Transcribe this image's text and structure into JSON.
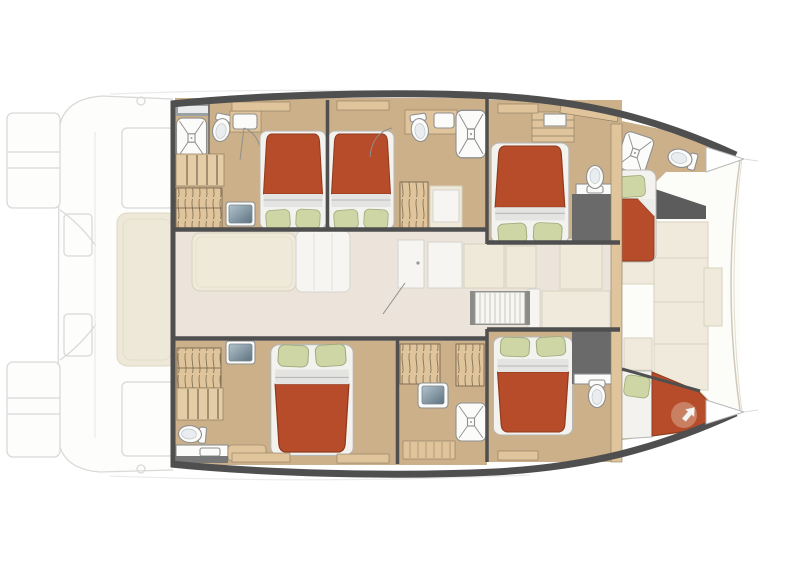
{
  "document": {
    "type": "floor-plan",
    "subject": "catamaran yacht interior deck plan, top view",
    "canvas": {
      "width": 800,
      "height": 572
    },
    "visible_text": "none"
  },
  "palette": {
    "bed": "#b64c2a",
    "bed_dark": "#8f3a1f",
    "pillow": "#cdd6a4",
    "pillow_edge": "#9dab7c",
    "sheet": "#e4e4e2",
    "sheet_line": "#b9b9b9",
    "cabin_floor": "#cbb08a",
    "wood": "#dfc49c",
    "wood_step": "#e4cda6",
    "hatch": "#85755a",
    "wall": "#4f4f4f",
    "wall_light": "#6a6a6a",
    "salon_floor": "#ece3da",
    "furniture_cream": "#efe9d9",
    "furniture_white": "#f6f5f1",
    "fixture": "#fbfbfa",
    "fixture_edge": "#8f8f8f",
    "glossy_hi": "#b3c3cc",
    "glossy_lo": "#5d7380",
    "panel": "#efeadb",
    "panel_edge": "#d7d1bf",
    "ghost": "#d9d9d9",
    "ghost_pad": "#ede8d8"
  },
  "fixture_counts": {
    "double_beds": 5,
    "single_bow_beds": 2,
    "showers": 5,
    "toilets": 6,
    "washbasins": 4,
    "hanging_wardrobes": 5,
    "staircases": 2
  },
  "rooms": [
    {
      "name": "aft-port-cabin",
      "fixtures": [
        "double-bed",
        "shower",
        "toilet",
        "washbasin",
        "stairs",
        "hanging-wardrobe",
        "vanity-table"
      ]
    },
    {
      "name": "mid-port-cabin",
      "fixtures": [
        "double-bed",
        "toilet",
        "washbasin",
        "shower",
        "hanging-wardrobe",
        "bench-seat"
      ]
    },
    {
      "name": "fore-port-cabin",
      "fixtures": [
        "double-bed",
        "toilet",
        "counter",
        "shelf-cabinet"
      ]
    },
    {
      "name": "port-bow-cabin",
      "fixtures": [
        "single-bed",
        "shower",
        "toilet"
      ]
    },
    {
      "name": "saloon",
      "fixtures": [
        "galley-island",
        "chart-table",
        "cabinets",
        "open-door",
        "slatted-deck-hatch"
      ]
    },
    {
      "name": "aft-starboard-cabin",
      "fixtures": [
        "double-bed",
        "toilet",
        "washbasin-counter",
        "stairs",
        "hanging-wardrobe",
        "vanity-table"
      ]
    },
    {
      "name": "mid-starboard-bathroom",
      "fixtures": [
        "hanging-wardrobe",
        "hanging-wardrobe",
        "washbasin",
        "shower"
      ]
    },
    {
      "name": "fore-starboard-cabin",
      "fixtures": [
        "double-bed",
        "toilet",
        "counter",
        "hanging-wardrobe"
      ]
    },
    {
      "name": "starboard-bow-cabin",
      "fixtures": [
        "single-wedge-bed",
        "shower",
        "access-arrow"
      ]
    },
    {
      "name": "aft-deck-ghosted",
      "fixtures": [
        "deck-outline",
        "swim-platforms",
        "lounge-pad"
      ]
    },
    {
      "name": "foredeck",
      "fixtures": [
        "sunpad-panels",
        "bow-crossbeam"
      ]
    }
  ]
}
